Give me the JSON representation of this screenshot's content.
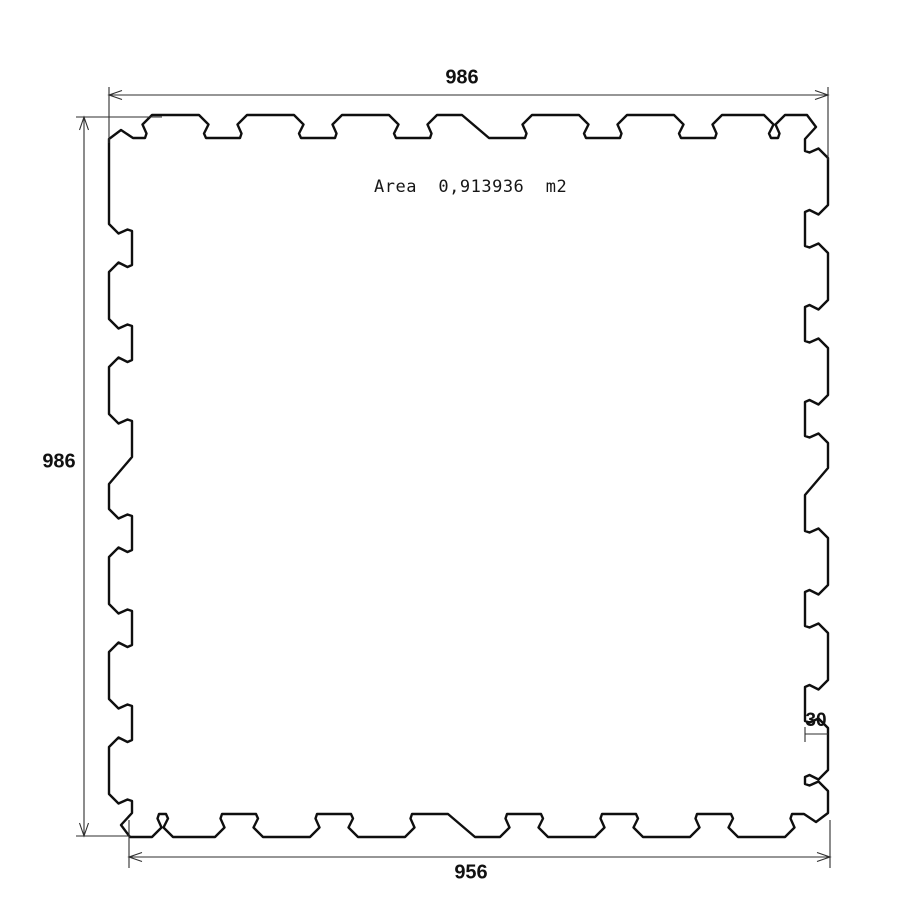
{
  "drawing": {
    "labels": {
      "dim_top": "986",
      "dim_left": "986",
      "dim_bottom": "956",
      "dim_tooth_depth": "30",
      "area": "Area  0,913936  m2"
    },
    "colors": {
      "background": "#ffffff",
      "outline": "#0f0f0f",
      "dimension_lines": "#2e2e2e",
      "text": "#111111"
    }
  }
}
